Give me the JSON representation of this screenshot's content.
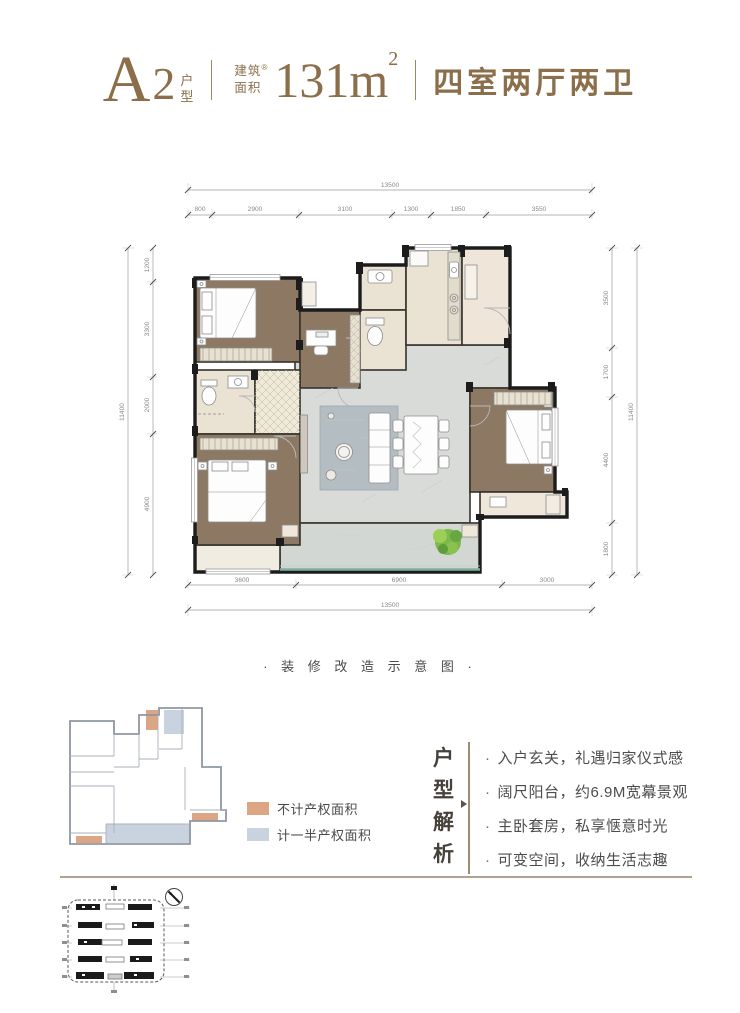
{
  "header": {
    "type_letter": "A",
    "type_number": "2",
    "type_suffix": [
      "户",
      "型"
    ],
    "area_label": [
      "建筑",
      "面积"
    ],
    "trademark": "®",
    "area_value": "131m",
    "area_exponent": "2",
    "rooms_desc": "四室两厅两卫"
  },
  "floor_plan": {
    "dims": {
      "top_total": "13500",
      "top_segments": [
        "800",
        "2900",
        "3100",
        "1300",
        "1850",
        "3550"
      ],
      "left_total": "11400",
      "left_segments": [
        "1200",
        "3300",
        "2000",
        "4900"
      ],
      "right_total": "11400",
      "right_segments": [
        "3500",
        "1700",
        "4400",
        "1800"
      ],
      "bottom_segments": [
        "3600",
        "6900",
        "3000"
      ],
      "bottom_total": "13500"
    }
  },
  "section_label": "· 装 修 改 造 示 意 图 ·",
  "legend": {
    "items": [
      {
        "label": "不计产权面积",
        "color": "#dca684"
      },
      {
        "label": "计一半产权面积",
        "color": "#c9d3df"
      }
    ]
  },
  "analysis": {
    "title_chars": [
      "户",
      "型",
      "解",
      "析"
    ],
    "bullet_prefix": "·",
    "bullets": [
      "入户玄关，礼遇归家仪式感",
      "阔尺阳台，约6.9M宽幕景观",
      "主卧套房，私享惬意时光",
      "可变空间，收纳生活志趣"
    ]
  },
  "colors": {
    "brand_brown": "#8b6e4a",
    "wood_floor": "#8d7963",
    "tile_gray": "#d8dbd8",
    "bath_beige": "#eae2d3",
    "wall_black": "#1f1f1f",
    "balcony_rail_teal": "#7fae9f",
    "divider_tan": "#b3a28c",
    "legend_orange": "#dca684",
    "legend_blue": "#c9d3df"
  }
}
